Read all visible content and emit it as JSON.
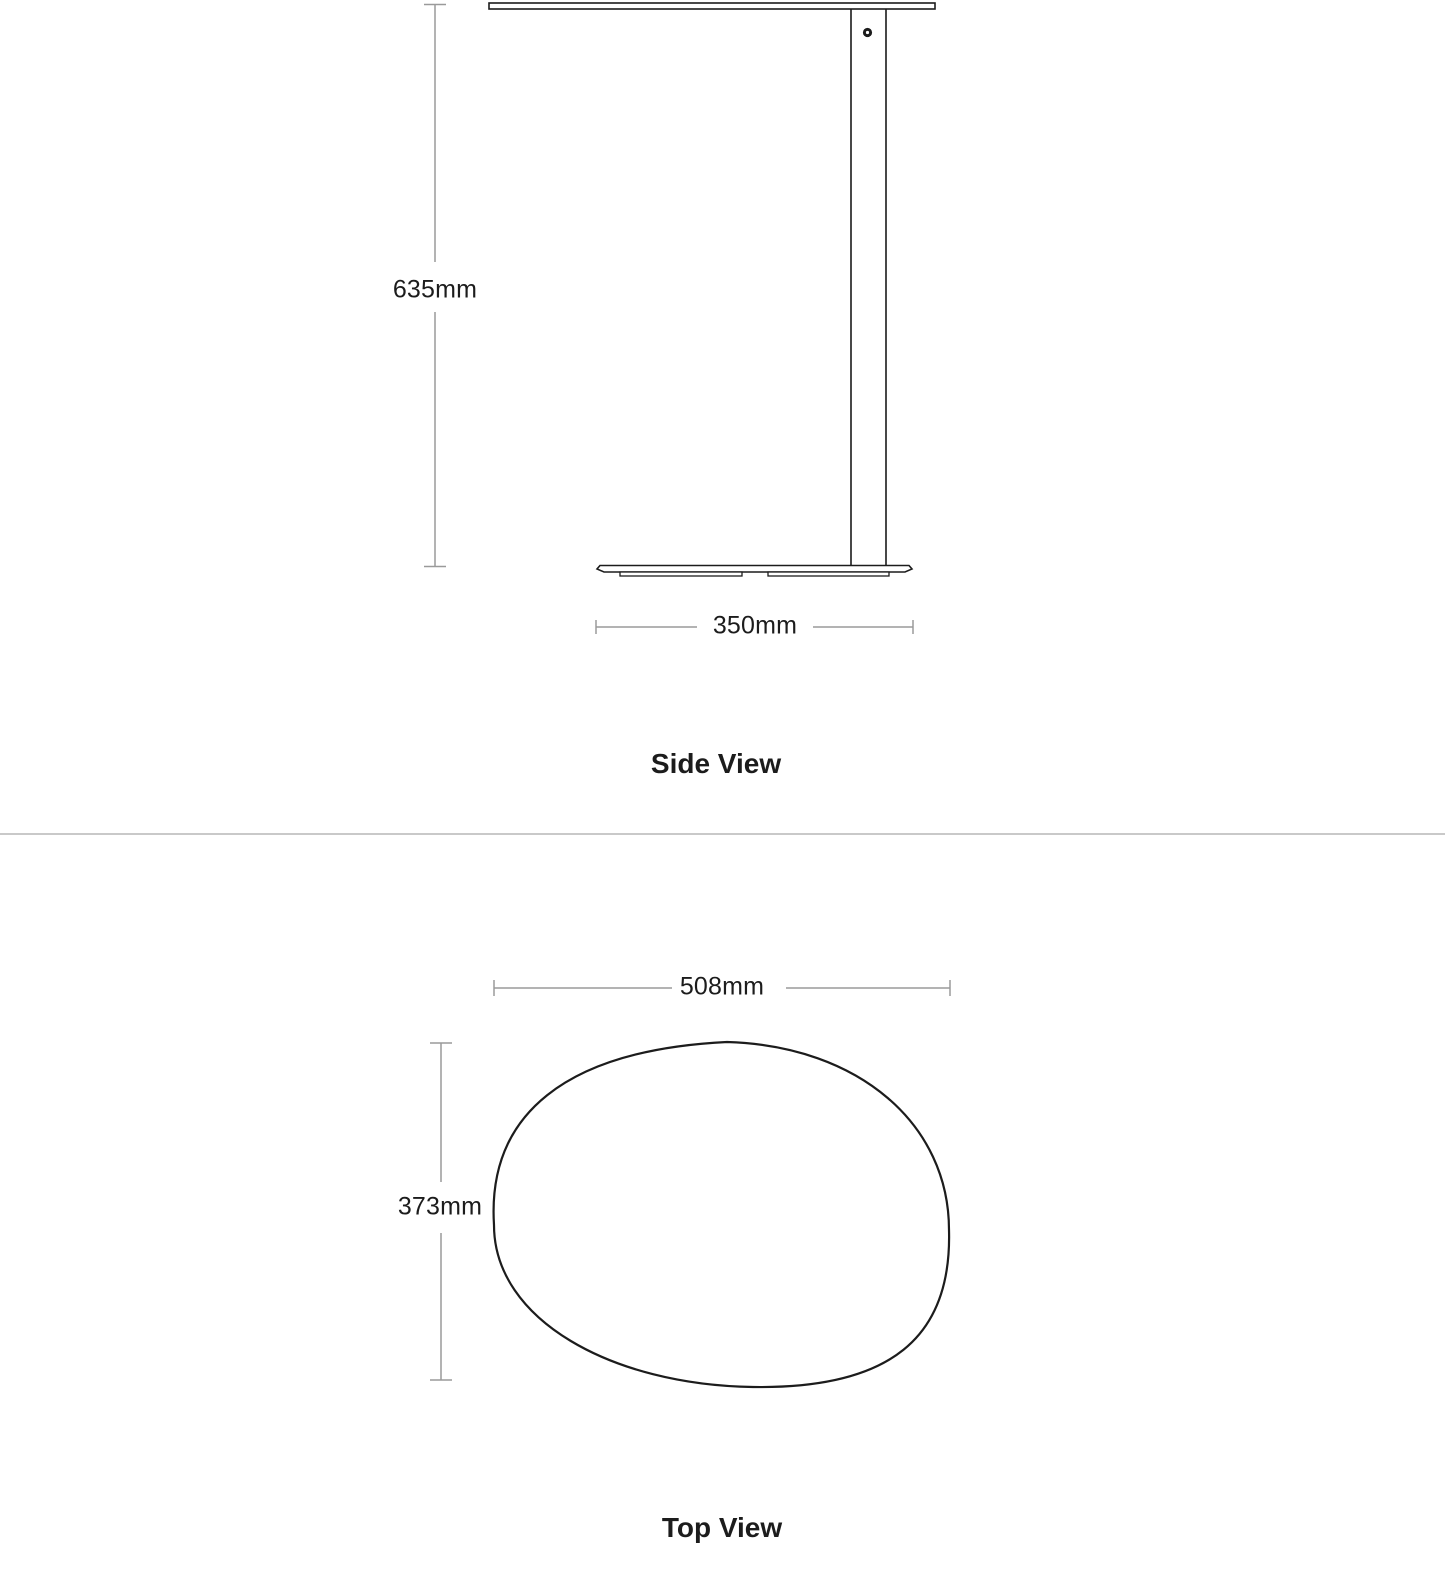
{
  "side_view": {
    "title": "Side View",
    "height_dimension": "635mm",
    "base_width_dimension": "350mm"
  },
  "top_view": {
    "title": "Top View",
    "width_dimension": "508mm",
    "depth_dimension": "373mm"
  },
  "colors": {
    "drawing_line": "#1c1c1c",
    "dimension_line": "#9a9a9a",
    "divider_line": "#c9c9c9",
    "text": "#1c1c1c",
    "background": "#ffffff"
  }
}
